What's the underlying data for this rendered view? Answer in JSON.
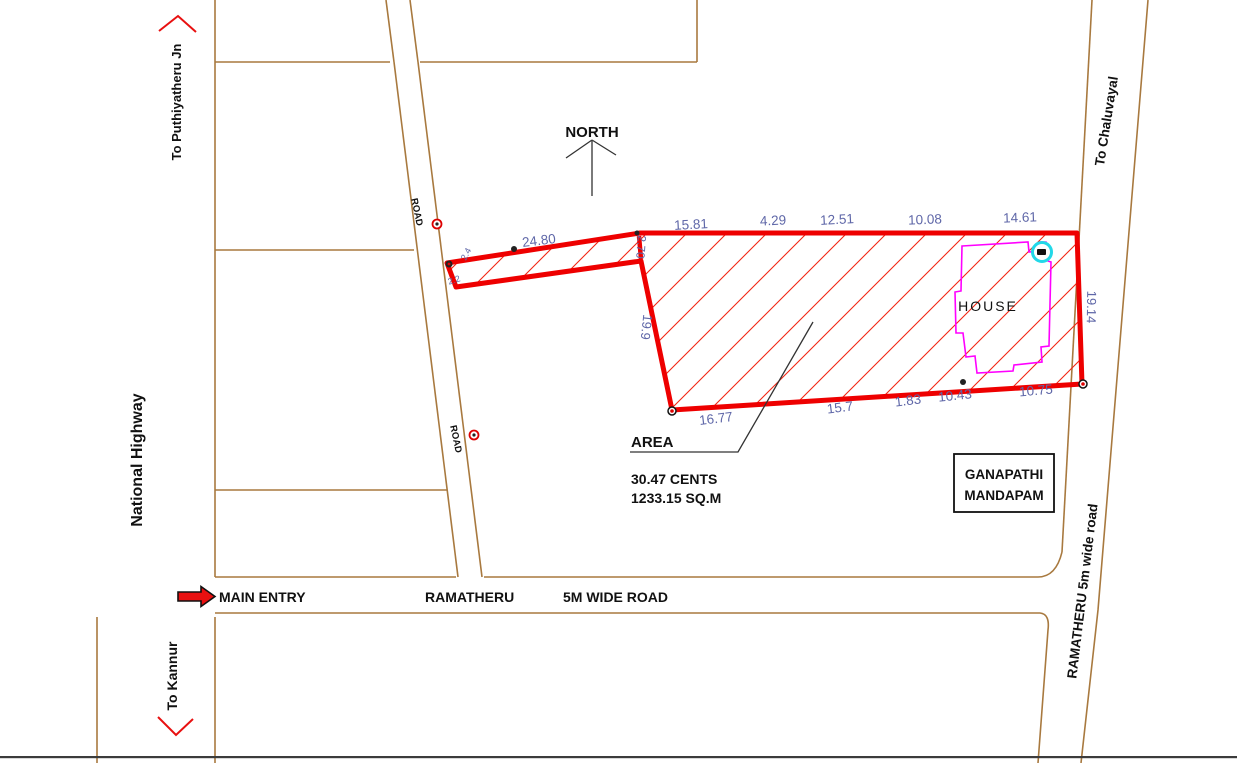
{
  "plan": {
    "compass": {
      "label": "NORTH"
    },
    "directions": {
      "puthiyatheru": "To Puthiyatheru Jn",
      "kannur": "To Kannur",
      "chaluvayal": "To Chaluvayal"
    },
    "roads": {
      "national_highway": "National Highway",
      "main_entry": "MAIN ENTRY",
      "ramatheru": "RAMATHERU",
      "wide_road": "5M WIDE ROAD",
      "ramatheru_side": "RAMATHERU 5m wide road",
      "road_label_upper": "ROAD",
      "road_label_lower": "ROAD"
    },
    "plot": {
      "area_title": "AREA",
      "area_cents": "30.47 CENTS",
      "area_sqm": "1233.15 SQ.M",
      "house": "HOUSE",
      "landmark_line1": "GANAPATHI",
      "landmark_line2": "MANDAPAM"
    },
    "dimensions": {
      "strip_top": "24.80",
      "top": [
        "15.81",
        "4.29",
        "12.51",
        "10.08",
        "14.61"
      ],
      "right": "19.14",
      "left": "19.9",
      "step": "2.70",
      "bottom": [
        "16.77",
        "15.7",
        "1.83",
        "10.43",
        "10.75"
      ],
      "tip_upper": "2.4",
      "tip_lower": "2.2"
    },
    "colors": {
      "plot_boundary": "#ee0000",
      "hatch": "#f22613",
      "road_line": "#a8793f",
      "dimension_text": "#5f67a8",
      "house_outline": "#ff00ff",
      "well": "#22d8e8",
      "entry_arrow": "#e81010",
      "text": "#111111"
    }
  }
}
